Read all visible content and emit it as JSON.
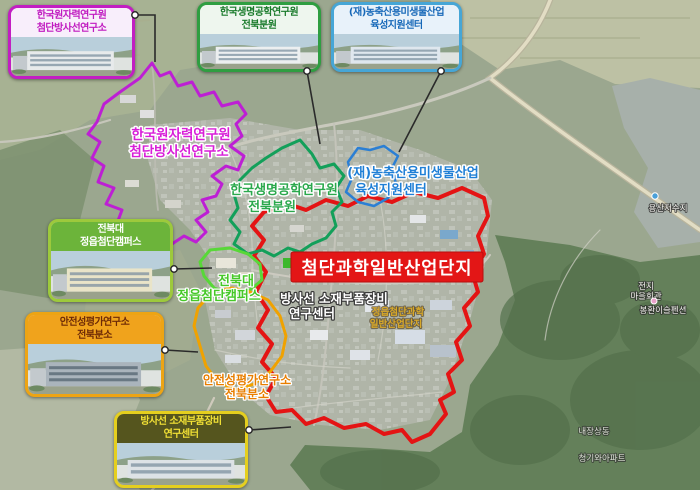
{
  "callouts": [
    {
      "id": "nuclear",
      "line1": "한국원자력연구원",
      "line2": "첨단방사선연구소",
      "color": "#c21ec2"
    },
    {
      "id": "bio",
      "line1": "한국생명공학연구원",
      "line2": "전북분원",
      "color": "#2f9e41"
    },
    {
      "id": "micro",
      "line1": "(재)농축산용미생물산업",
      "line2": "육성지원센터",
      "color": "#46a6d6"
    },
    {
      "id": "jbnu",
      "line1": "전북대",
      "line2": "정읍첨단캠퍼스",
      "color": "#9dc93c"
    },
    {
      "id": "kit",
      "line1": "안전성평가연구소",
      "line2": "전북분소",
      "color": "#eda414"
    },
    {
      "id": "rad",
      "line1": "방사선 소재부품장비",
      "line2": "연구센터",
      "color": "#e5cf1e"
    }
  ],
  "map": {
    "industrial_complex_label": "첨단과학일반산업단지",
    "industrial_complex_color": "#e31616",
    "areas": [
      {
        "name": "한국원자력연구원 첨단방사선연구소",
        "outline_color": "#bd1fd4"
      },
      {
        "name": "한국생명공학연구원 전북분원",
        "outline_color": "#13a05a"
      },
      {
        "name": "(재)농축산용미생물산업 육성지원센터",
        "outline_color": "#2b7fd4"
      },
      {
        "name": "전북대 정읍첨단캠퍼스",
        "outline_color": "#58d838"
      },
      {
        "name": "안전성평가연구소 전북분소",
        "outline_color": "#f0a200"
      },
      {
        "name": "첨단과학일반산업단지",
        "outline_color": "#e41414"
      }
    ],
    "labels": [
      {
        "id": "nuclear",
        "line1": "한국원자력연구원",
        "line2": "첨단방사선연구소",
        "color": "#d81fd8"
      },
      {
        "id": "bio",
        "line1": "한국생명공학연구원",
        "line2": "전북분원",
        "color": "#2aa84c"
      },
      {
        "id": "micro",
        "line1": "(재)농축산용미생물산업",
        "line2": "육성지원센터",
        "color": "#1f7fd6"
      },
      {
        "id": "jbnu",
        "line1": "전북대",
        "line2": "정읍첨단캠퍼스",
        "color": "#46c828"
      },
      {
        "id": "rad",
        "line1": "방사선 소재부품장비",
        "line2": "연구센터",
        "color": "#ffffff"
      },
      {
        "id": "kit",
        "line1": "안전성평가연구소",
        "line2": "전북분소",
        "color": "#e87e00"
      }
    ],
    "small_label": {
      "line1": "정읍첨단과학",
      "line2": "일반산업단지",
      "color": "#d8a828"
    },
    "minor_labels": [
      {
        "text": "용산저수지"
      },
      {
        "text": "전지"
      },
      {
        "text": "마을회관"
      },
      {
        "text": "봉환이슬펜션"
      },
      {
        "text": "내장상동"
      },
      {
        "text": "청기와아파트"
      }
    ]
  }
}
